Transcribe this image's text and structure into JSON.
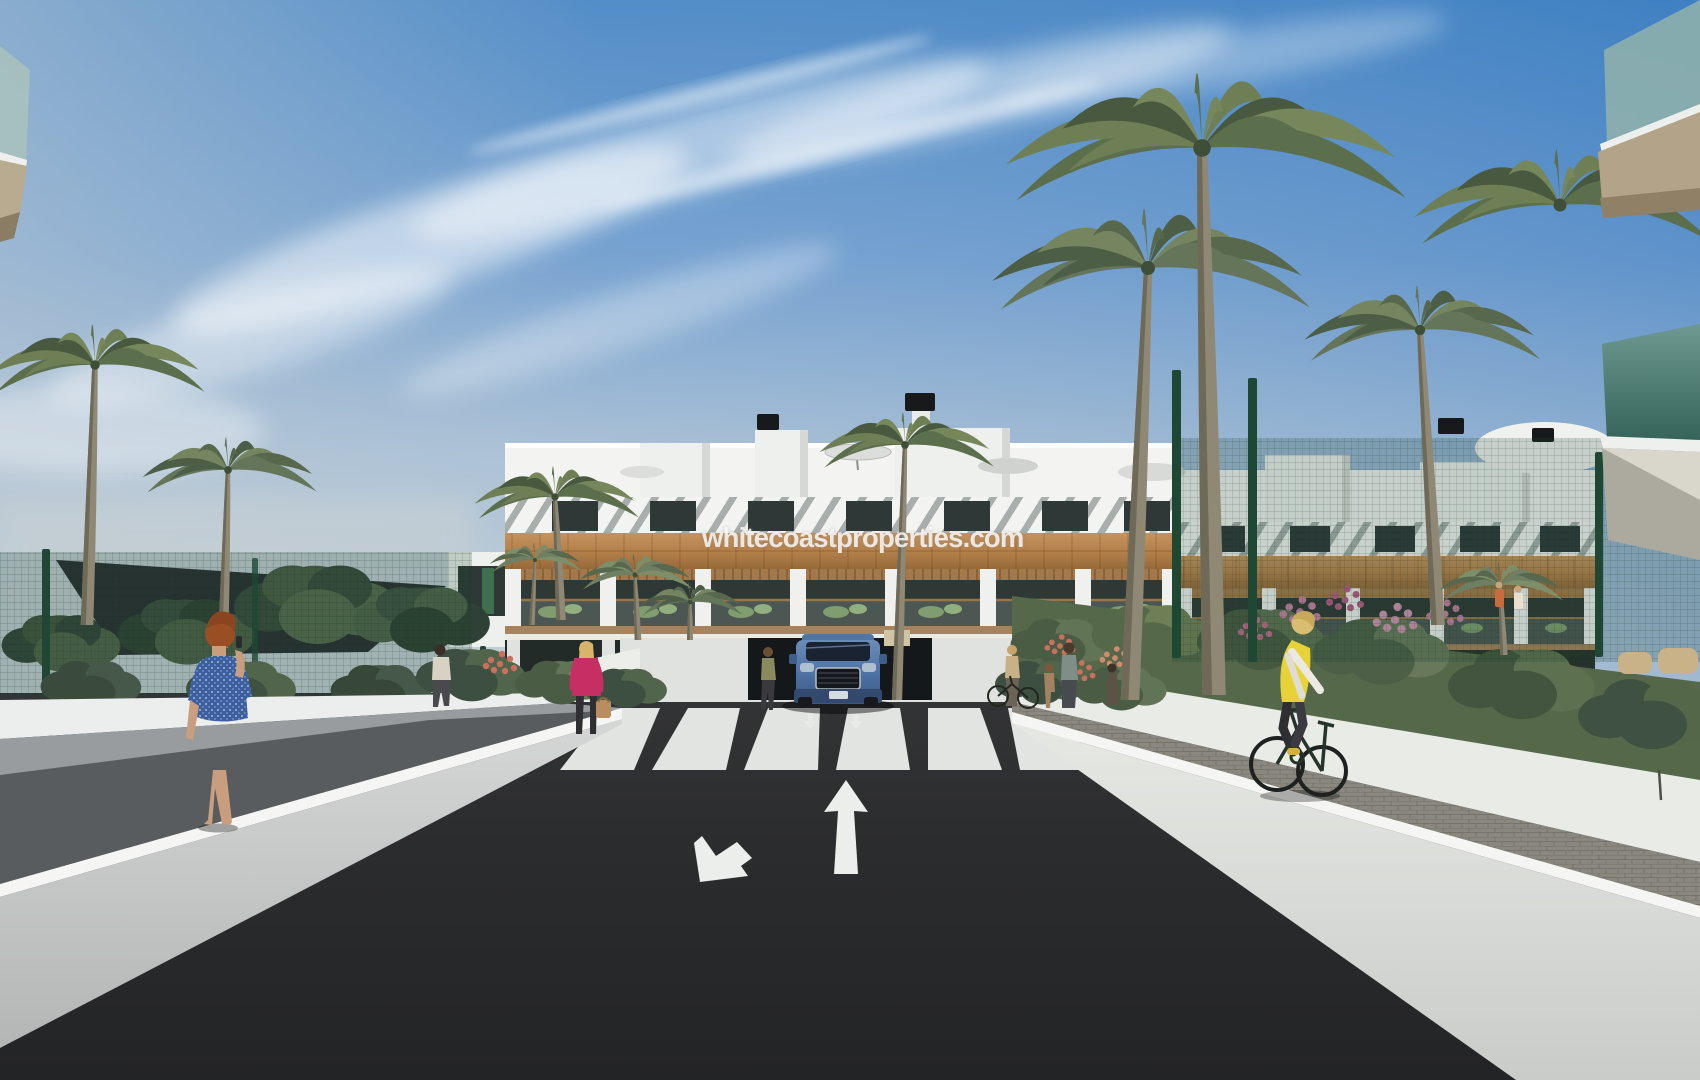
{
  "image": {
    "type": "architectural-exterior-render",
    "description": "Photorealistic 3D render of a new-build Mediterranean apartment complex: white three-storey blocks with wood cladding and slatted pergola roofs, palm trees, gardens, a dark asphalt access road with zebra crossing leading to an underground garage ramp where a blue SUV exits.",
    "watermark": "whitecoastproperties.com",
    "scene": {
      "sky": "bright blue sky with wispy diagonal clouds, hazier toward left horizon",
      "building": "white apartment block, slatted pergola roof band, wood-clad facade band, glass-and-wood balconies with green outdoor furniture, rooftop parasols and black vent chimneys",
      "road": "dark asphalt lane with white zebra crossing, one arrow toward viewer and one arrow away",
      "garage": "central ramp to underground parking flanked by white planter walls",
      "car": "blue SUV facing viewer at top of garage ramp",
      "people": [
        "red-haired woman in blue patterned dress on phone, left walkway",
        "man in light shirt walking on left path",
        "blonde woman in pink jacket carrying a bag",
        "woman standing beside the SUV ramp",
        "group with bicycle and child near right ramp wall",
        "cyclist in yellow vest riding on right paved path",
        "two small figures on far right balcony"
      ],
      "landscaping": "tall palm trees, dark shade canopy over sports court at left, green mesh fencing both sides, flowering pink and coral gardens at right, white retaining walls"
    },
    "colors": {
      "sky_top": "#4485c6",
      "sky_horizon": "#ccd5da",
      "cloud": "#ffffff",
      "building_white": "#f3f4f2",
      "wood_band": "#b5814b",
      "pergola_stripe": "#a7aeac",
      "window_glass": "#2e3837",
      "asphalt": "#2b2c2e",
      "road_marking": "#eceeec",
      "wall_white": "#eceeeb",
      "walkway_gray": "#989c9e",
      "brick_path": "#8a887e",
      "fence_green": "#2c5d45",
      "canopy_dark": "#22282a",
      "palm_green": "#5c6f4d",
      "car_blue": "#4f74a6",
      "vest_yellow": "#e7d337",
      "jacket_pink": "#c72e63",
      "dress_blue": "#3c5fa0",
      "hair_auburn": "#9a4e24"
    }
  }
}
